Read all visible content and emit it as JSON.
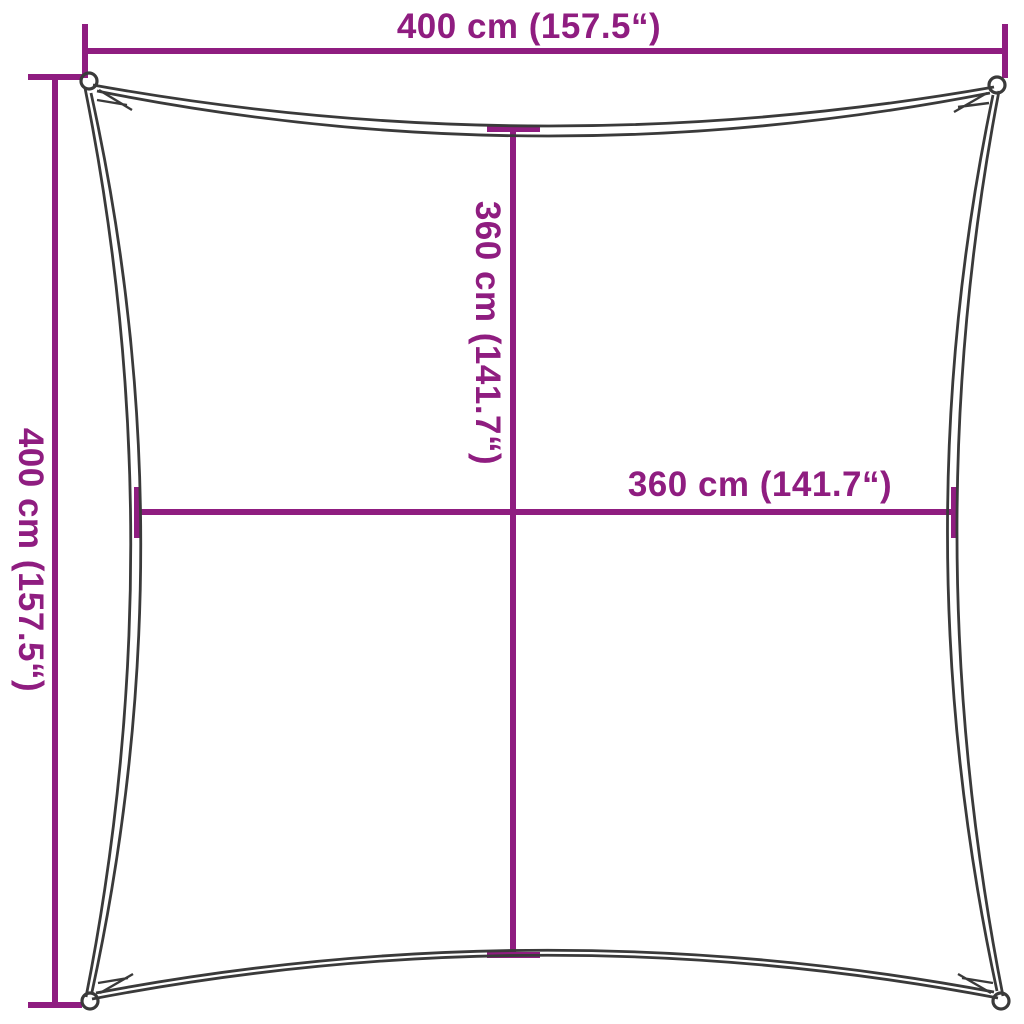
{
  "diagram": {
    "title": "Square shade sail dimension diagram",
    "background_color": "#ffffff",
    "accent_color": "#8F1D80",
    "outline_color": "#3A3A3A",
    "dimensions": {
      "top": {
        "label": "400 cm (157.5“)",
        "value_cm": 400,
        "value_in": 157.5
      },
      "left": {
        "label": "400 cm (157.5“)",
        "value_cm": 400,
        "value_in": 157.5
      },
      "center_vertical": {
        "label": "360 cm (141.7“)",
        "value_cm": 360,
        "value_in": 141.7
      },
      "center_horizontal": {
        "label": "360 cm (141.7“)",
        "value_cm": 360,
        "value_in": 141.7
      }
    }
  }
}
